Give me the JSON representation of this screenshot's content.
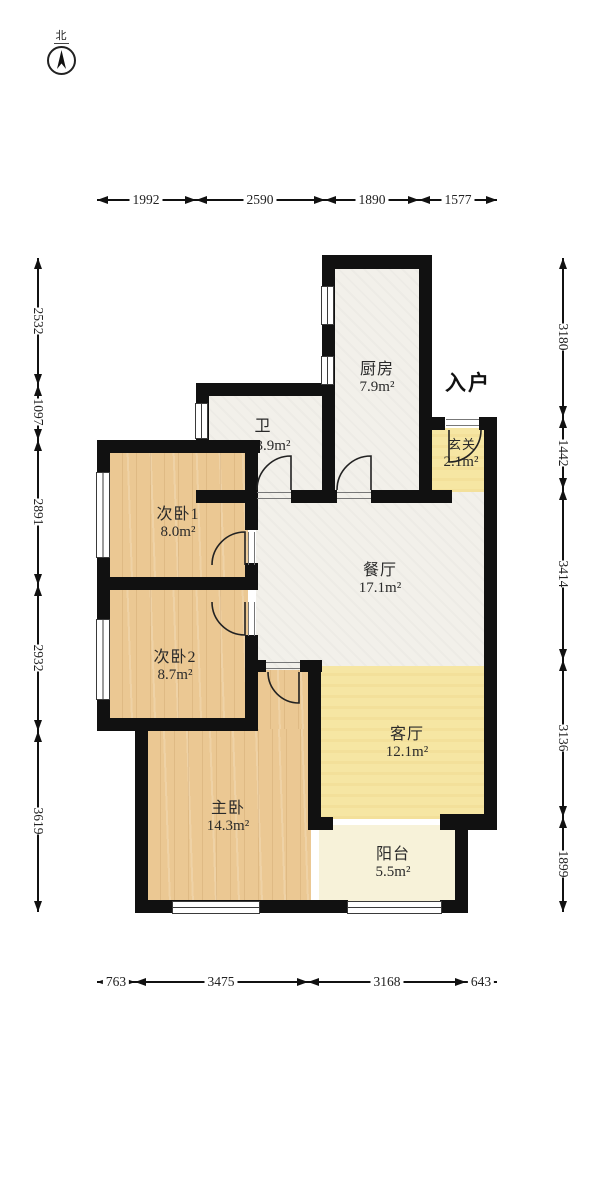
{
  "compass": {
    "label": "北"
  },
  "entrance": {
    "label": "入户"
  },
  "rooms": {
    "kitchen": {
      "name": "厨房",
      "area": "7.9m²"
    },
    "bath": {
      "name": "卫",
      "area": "3.9m²"
    },
    "bedroom1": {
      "name": "次卧1",
      "area": "8.0m²"
    },
    "bedroom2": {
      "name": "次卧2",
      "area": "8.7m²"
    },
    "dining": {
      "name": "餐厅",
      "area": "17.1m²"
    },
    "living": {
      "name": "客厅",
      "area": "12.1m²"
    },
    "master": {
      "name": "主卧",
      "area": "14.3m²"
    },
    "balcony": {
      "name": "阳台",
      "area": "5.5m²"
    },
    "entry": {
      "name": "玄关",
      "area": "2.1m²"
    }
  },
  "dimensions": {
    "top": [
      "1992",
      "2590",
      "1890",
      "1577"
    ],
    "bottom": [
      "763",
      "3475",
      "3168",
      "643"
    ],
    "left": [
      "2532",
      "1097",
      "2891",
      "2932",
      "3619"
    ],
    "right": [
      "3180",
      "1442",
      "3414",
      "3136",
      "1899"
    ]
  },
  "colors": {
    "wall": "#111111",
    "wood_floor": "#ebc893",
    "tile_floor": "#f2f0ea",
    "living_yellow": "#f6e6a3",
    "balcony_cream": "#f7f2d9"
  }
}
